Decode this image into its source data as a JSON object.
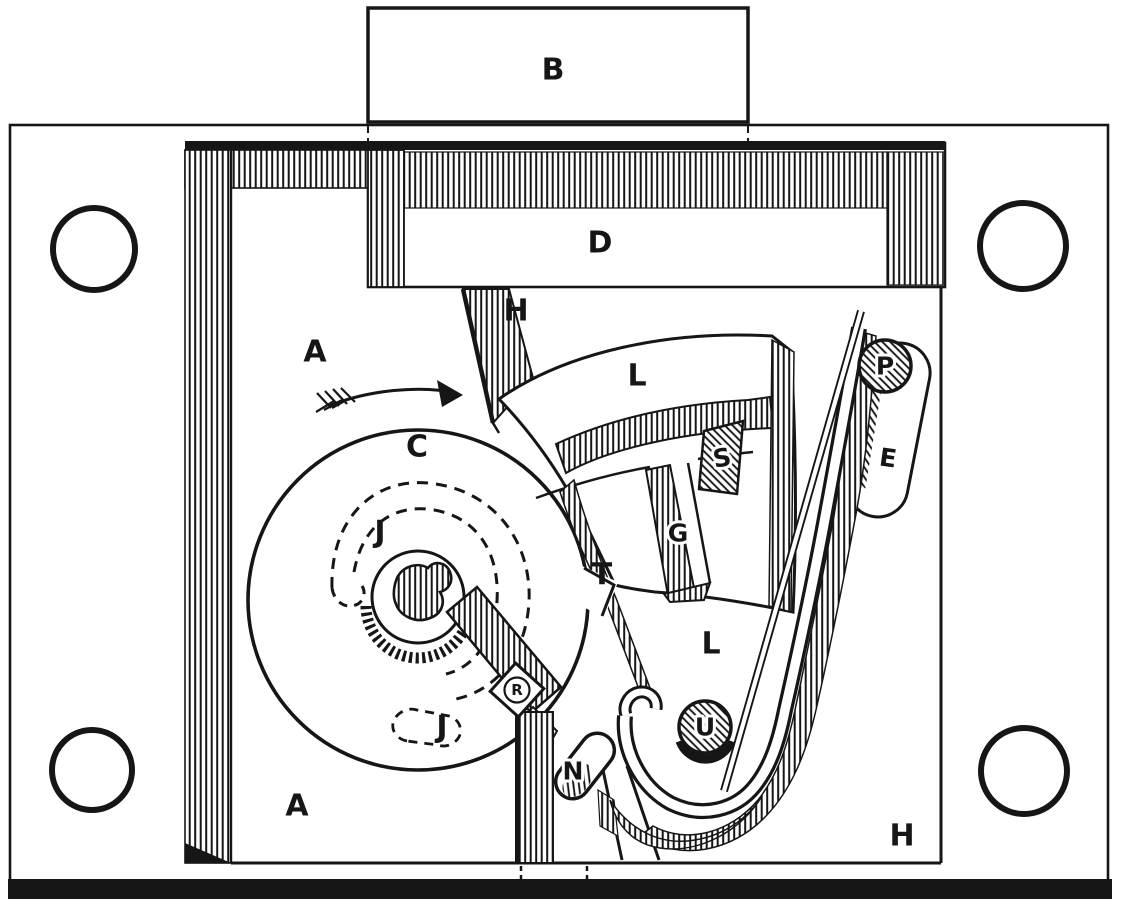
{
  "colors": {
    "paper": "#ffffff",
    "ink": "#161616"
  },
  "labels": {
    "a_upper": "A",
    "a_lower": "A",
    "b": "B",
    "c": "C",
    "d": "D",
    "e": "E",
    "g": "G",
    "h_upper": "H",
    "h_lower": "H",
    "j_upper": "J",
    "j_lower": "J",
    "l_upper": "L",
    "l_lower": "L",
    "n": "N",
    "p": "P",
    "r": "R",
    "s": "S",
    "t": "T",
    "u": "U"
  }
}
